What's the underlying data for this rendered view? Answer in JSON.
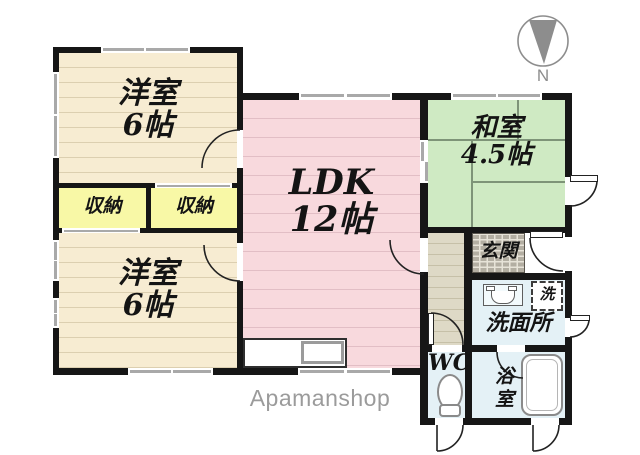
{
  "plan_title": "apartment-floor-plan",
  "rooms": {
    "western_top": {
      "name": "洋室",
      "size": "6帖"
    },
    "western_bottom": {
      "name": "洋室",
      "size": "6帖"
    },
    "ldk": {
      "name": "LDK",
      "size": "12帖"
    },
    "japanese": {
      "name": "和室",
      "size": "4.5帖"
    },
    "closet_left": {
      "name": "収納"
    },
    "closet_right": {
      "name": "収納"
    },
    "entrance": {
      "name": "玄関"
    },
    "washroom": {
      "name": "洗面所"
    },
    "wc": {
      "name": "WC"
    },
    "bathroom": {
      "name": "浴室"
    },
    "laundry_spot": {
      "name": "洗"
    }
  },
  "compass": {
    "label": "N"
  },
  "watermark": "Apamanshop",
  "colors": {
    "wall": "#161616",
    "western_room_fill": "#f7ecd2",
    "ldk_fill": "#f8d9dd",
    "tatami_fill": "#cfeac3",
    "closet_fill": "#f8f8a6",
    "hallway_fill": "#ded9c6",
    "entry_tile": "#b3aea2",
    "wet_room_fill": "#e4f1f6",
    "window_glass": "#a9a9a9",
    "compass_gray": "#8d8d8d",
    "watermark_gray": "#9b9b9b"
  }
}
